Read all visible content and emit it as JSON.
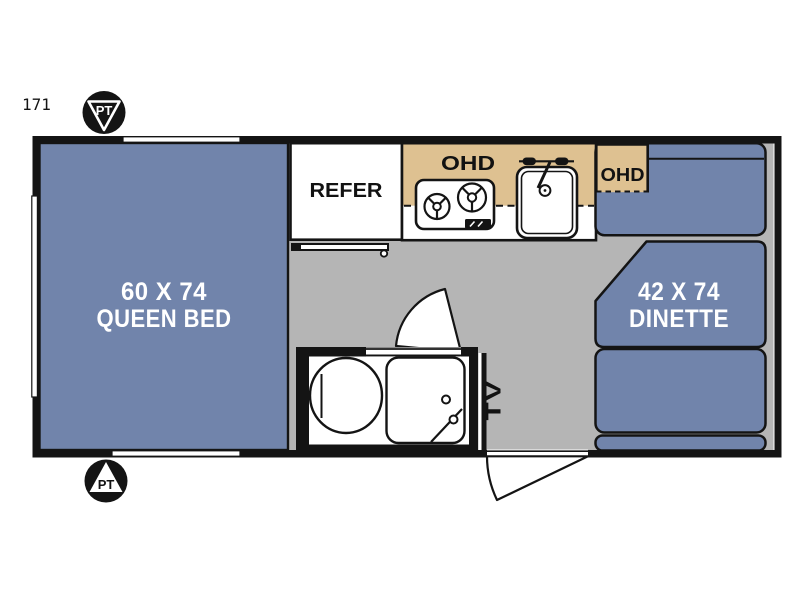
{
  "floorplan": {
    "model_number": "171",
    "markers": {
      "top": "PT",
      "bottom": "PT"
    },
    "bed": {
      "size": "60 X 74",
      "label": "QUEEN BED"
    },
    "dinette": {
      "size": "42 X 74",
      "label": "DINETTE"
    },
    "kitchen": {
      "refrigerator": "REFER",
      "overhead_cabinet": "OHD"
    },
    "dinette_overhead": "OHD",
    "tv_label": "TV",
    "colors": {
      "furniture_blue": "#7184ab",
      "cabinet_tan": "#dec191",
      "floor_gray": "#b5b5b5",
      "wall_black": "#141414",
      "label_white": "#ffffff",
      "label_black": "#121212"
    }
  }
}
